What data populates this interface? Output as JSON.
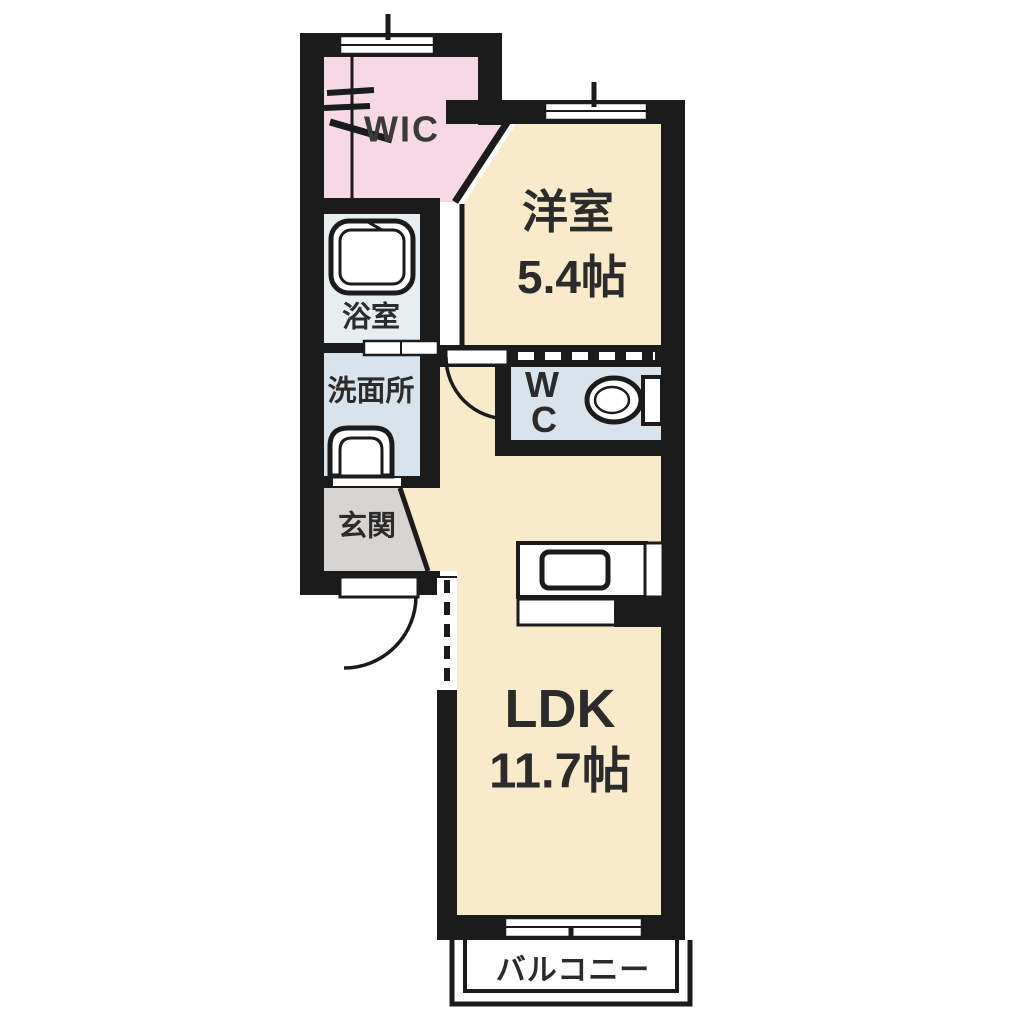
{
  "diagram": {
    "kind": "japanese-apartment-floor-plan",
    "rooms": {
      "wic": {
        "label": "WIC"
      },
      "bedroom": {
        "label": "洋室",
        "size": "5.4帖"
      },
      "bathroom": {
        "label": "浴室"
      },
      "washroom": {
        "label": "洗面所"
      },
      "entrance": {
        "label": "玄関"
      },
      "toilet": {
        "label_line1": "W",
        "label_line2": "C"
      },
      "ldk": {
        "label": "LDK",
        "size": "11.7帖"
      },
      "balcony": {
        "label": "バルコニー"
      }
    },
    "fixtures": [
      "bathtub-icon",
      "washbasin-icon",
      "toilet-icon",
      "kitchen-sink-icon",
      "hanger-rack-icon"
    ],
    "colors": {
      "wall": "#1b1b1b",
      "room_cream": "#F8EACA",
      "wic_pink": "#F6D9E4",
      "wet_blue": "#D9E3EB",
      "bath_gray": "#E8EDF0",
      "entrance_gray": "#D7D4D1",
      "background": "#FFFFFF"
    }
  }
}
